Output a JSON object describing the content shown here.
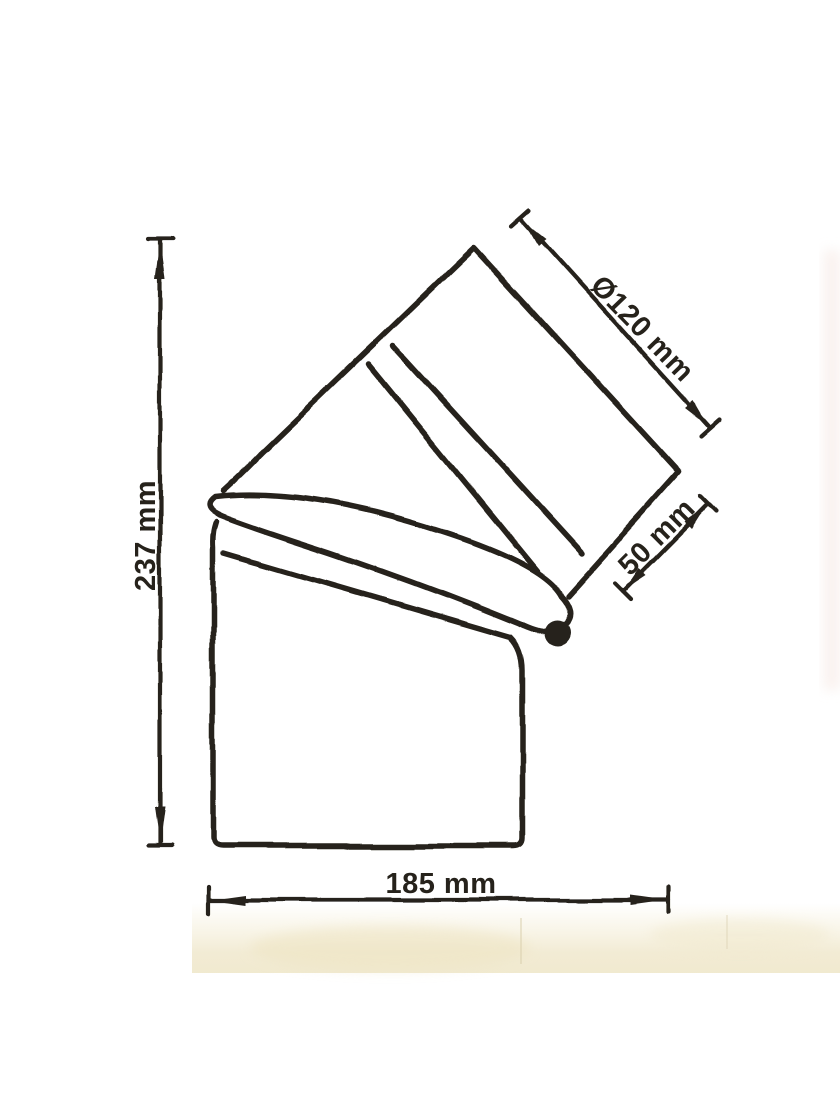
{
  "drawing": {
    "subject": "Dimensioned technical drawing of a 45-degree flue pipe elbow",
    "dimensions": {
      "height": {
        "label": "237 mm",
        "value": 237,
        "unit": "mm"
      },
      "width": {
        "label": "185 mm",
        "value": 185,
        "unit": "mm"
      },
      "diameter": {
        "label": "Ø120 mm",
        "value": 120,
        "unit": "mm"
      },
      "offset": {
        "label": "50 mm",
        "value": 50,
        "unit": "mm"
      }
    },
    "colors": {
      "ink": "#26221b",
      "paper": "#ffffff",
      "stain": "#f0e8cd"
    }
  }
}
